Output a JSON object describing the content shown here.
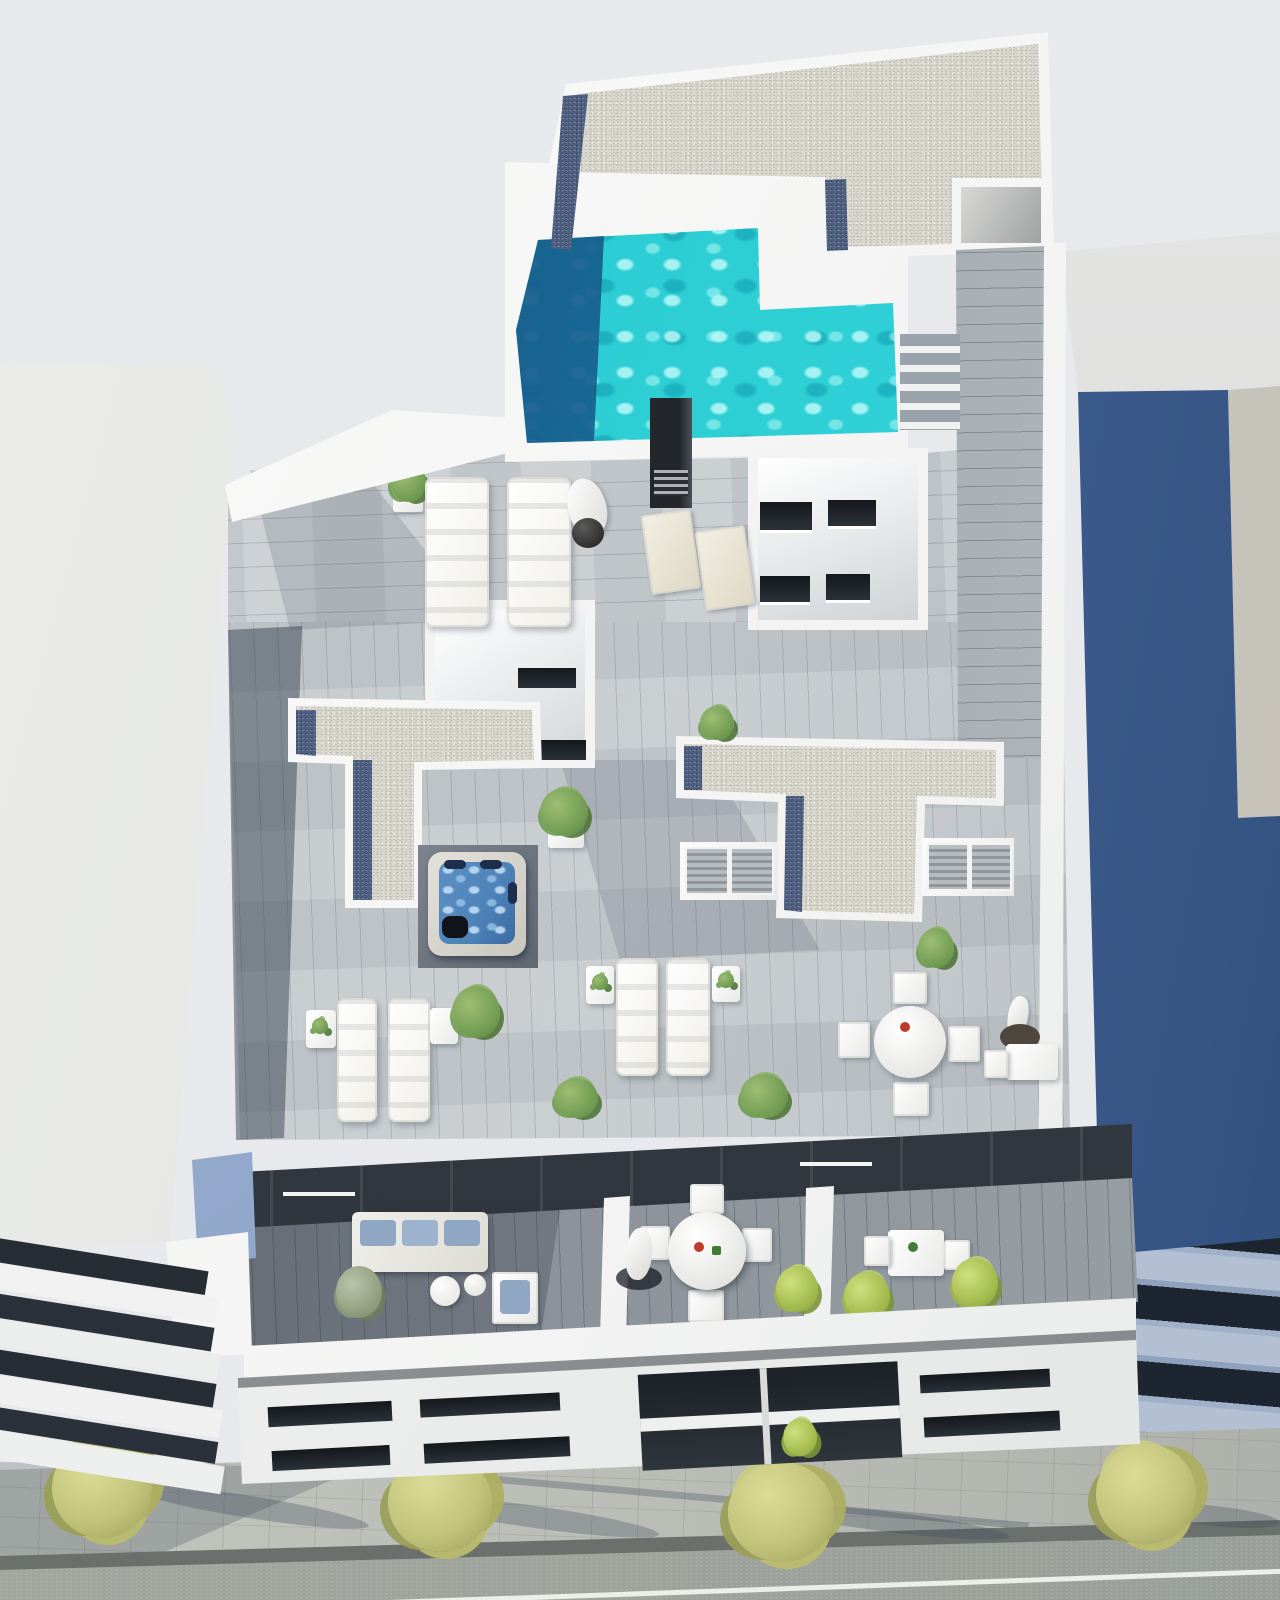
{
  "scene": {
    "title": "aerial-architectural-render",
    "description": "Bird's-eye 3D architectural rendering of a modern white apartment building with a turquoise rooftop pool, gravel roofs, wood-deck terraces with sun loungers, a jacuzzi, dining sets, planted balconies, neighbouring buildings and a tree-lined street below",
    "objects": [
      "rooftop-pool",
      "gravel-roof",
      "blue-gravel-border",
      "pool-deck",
      "sun-loungers",
      "parasol",
      "deck-chairs",
      "skylight-lightwell",
      "stair-core",
      "jacuzzi",
      "hot-tub",
      "louvered-shutters",
      "roof-terraces",
      "side-tables",
      "potted-plants",
      "round-dining-table",
      "dining-chairs",
      "balconies",
      "outdoor-sofa",
      "armchair",
      "street-facade",
      "window-bands",
      "sidewalk",
      "street-trees",
      "road",
      "curb",
      "left-neighbour-building",
      "right-neighbour-building",
      "stairs",
      "vent-chimney"
    ]
  },
  "palette": {
    "sky": "#e7e9ec",
    "wall_white": "#f2f3f2",
    "wall_shade": "#dfe2e4",
    "neighbor_left_wall": "#e4e5e2",
    "gravel_light": "#d9d6cd",
    "gravel_blue": "#4d5e7e",
    "pool_turquoise": "#2fd0d6",
    "pool_ripple": "#a5f2ef",
    "pool_deep": "#15537e",
    "deck_light": "#c6cbce",
    "deck_shadow": "#5c6874",
    "balcony_deck": "#9aa1a6",
    "glass_dark": "#2b3138",
    "spa_water": "#4d82b8",
    "plant_green": "#6e9a50",
    "tree_olive": "#c3c47c",
    "sidewalk": "#b9bcb5",
    "curb": "#6b6f6c",
    "road": "#9aa099",
    "neighbor_blue_wall": "#44659a",
    "neighbor_slab_light": "#b3c0d4",
    "neighbor_band_dark": "#1d2530",
    "furniture_white": "#f7f7f5",
    "cushion_blue": "#90a7c4",
    "accent_red": "#c0392b"
  }
}
